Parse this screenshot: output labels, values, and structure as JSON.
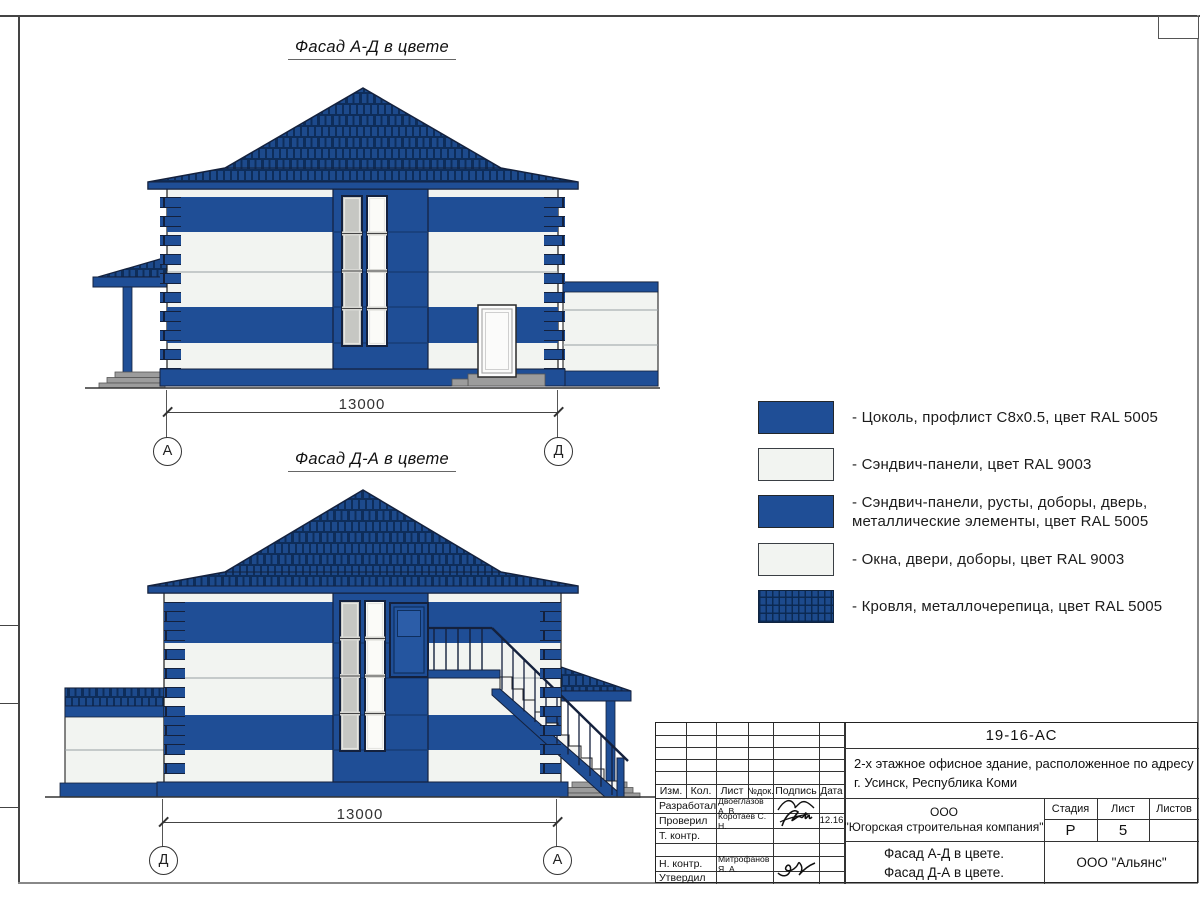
{
  "frame": {
    "note": "drawing sheet frame"
  },
  "colors": {
    "panel_blue": "#1f4e96",
    "roof_blue": "#1d4a8c",
    "roof_dark_line": "#0e2d5a",
    "panel_white": "#f2f4f1",
    "steps_gray": "#9c9c9c"
  },
  "facade1": {
    "title": "Фасад А-Д в цвете",
    "dimension": "13000",
    "axis_left": "А",
    "axis_right": "Д"
  },
  "facade2": {
    "title": "Фасад Д-А в цвете",
    "dimension": "13000",
    "axis_left": "Д",
    "axis_right": "А"
  },
  "legend": {
    "items": [
      {
        "swatch": "blue-solid",
        "label": "- Цоколь, профлист С8х0.5, цвет RAL 5005"
      },
      {
        "swatch": "white",
        "label": "- Сэндвич-панели, цвет RAL 9003"
      },
      {
        "swatch": "blue-solid",
        "label": "- Сэндвич-панели, русты, доборы, дверь,\nметаллические элементы, цвет RAL 5005"
      },
      {
        "swatch": "white",
        "label": "- Окна, двери, доборы, цвет RAL 9003"
      },
      {
        "swatch": "roof-tile",
        "label": "- Кровля, металлочерепица, цвет RAL 5005"
      }
    ]
  },
  "title_block": {
    "doc_number": "19-16-АС",
    "project_desc": "2-х этажное офисное здание, расположенное по адресу г. Усинск, Республика Коми",
    "org_line1": "ООО",
    "org_line2": "\"Югорская строительная компания\"",
    "stage_label": "Стадия",
    "sheet_label": "Лист",
    "sheets_label": "Листов",
    "stage_value": "Р",
    "sheet_value": "5",
    "sheets_value": "",
    "content_line1": "Фасад А-Д в цвете.",
    "content_line2": "Фасад Д-А в цвете.",
    "company": "ООО \"Альянс\"",
    "cols": {
      "izm": "Изм.",
      "kol": "Кол.",
      "list": "Лист",
      "ndok": "№док.",
      "podpis": "Подпись",
      "data": "Дата"
    },
    "rows": [
      {
        "role": "Разработал",
        "name": "Двоеглазов А. В.",
        "date": ""
      },
      {
        "role": "Проверил",
        "name": "Коротаев С. Н.",
        "date": "12.16"
      },
      {
        "role": "Т. контр.",
        "name": "",
        "date": ""
      },
      {
        "role": "",
        "name": "",
        "date": ""
      },
      {
        "role": "Н. контр.",
        "name": "Митрофанов Я. А.",
        "date": ""
      },
      {
        "role": "Утвердил",
        "name": "",
        "date": ""
      }
    ]
  }
}
